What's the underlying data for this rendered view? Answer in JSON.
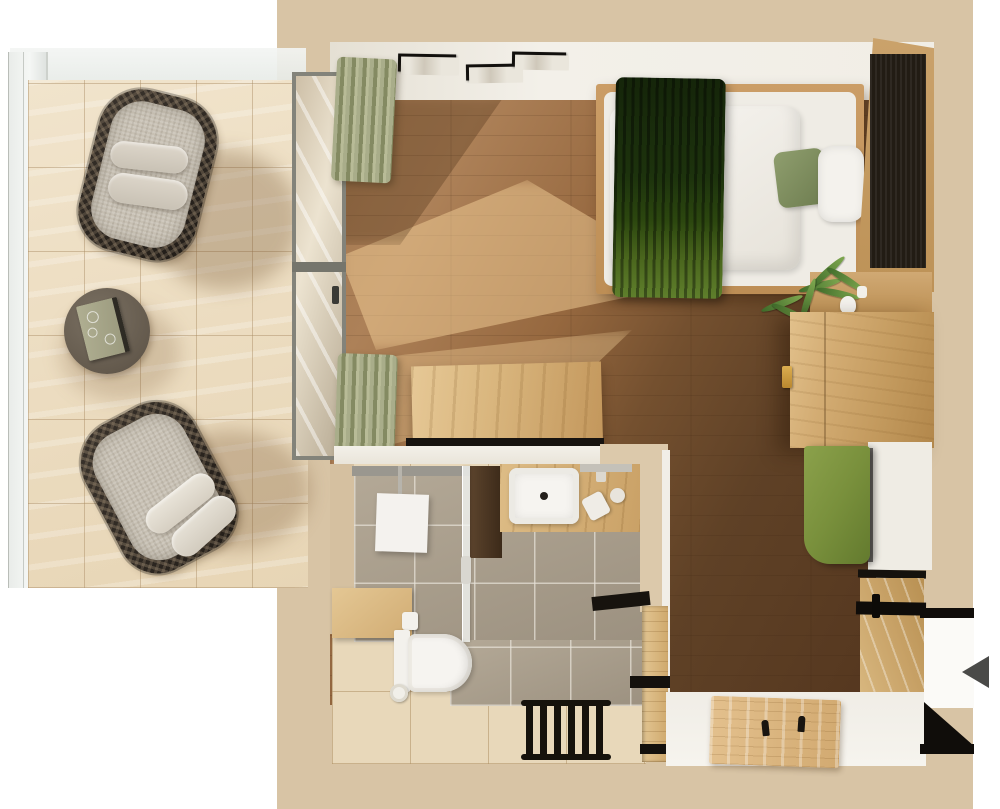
{
  "scene": {
    "title": "Studio apartment floor plan - top-down 3D render",
    "view": "top-down",
    "entrance_indicator": "left-pointing arrow at right wall opening"
  },
  "palette": {
    "page_background": "#ffffff",
    "wall_fill_beige": "#d8c4a5",
    "wall_top_white": "#f1eee7",
    "floor_wood_light": "#ad8158",
    "floor_wood_dark": "#55371f",
    "floor_sunlight": "#f3d098",
    "terrace_deck": "#ebdcc2",
    "glass_railing": "#eef1ef",
    "oak_furniture": "#cfa96f",
    "walnut_headboard": "#221c14",
    "bed_linen_white": "#efece5",
    "throw_green_dark": "#1d330d",
    "pillow_sage": "#8b9a6b",
    "bench_olive": "#79903c",
    "curtain_sage": "#9aa07c",
    "bathroom_tile_gray": "#aba08f",
    "bathroom_floor_tile": "#e8d8ba",
    "fixture_white": "#f6f4f0",
    "accent_black": "#14110d",
    "handle_gold": "#c89a3c",
    "arrow_gray": "#4a4a48"
  },
  "rooms": [
    {
      "id": "terrace",
      "name": "Terrace",
      "furniture": [
        "wood deck tiles",
        "glass railing",
        "lounge chair",
        "lounge chair",
        "round side table with book"
      ]
    },
    {
      "id": "living",
      "name": "Living / sleeping area",
      "furniture": [
        "double bed with green throw",
        "sage pillow",
        "white pillow",
        "walnut headboard panel",
        "three framed pictures",
        "sage curtains",
        "glass terrace door",
        "wall desk",
        "oak wardrobe",
        "olive upholstered bench",
        "shelf with plant and vases"
      ]
    },
    {
      "id": "bathroom",
      "name": "Bathroom",
      "furniture": [
        "walk-in shower",
        "rain shower head",
        "glass partition",
        "washbasin on oak counter",
        "wall-hung toilet",
        "toilet paper roll",
        "black towel radiator",
        "wood bench",
        "oak sliding door"
      ]
    },
    {
      "id": "entry",
      "name": "Entry",
      "furniture": [
        "oak coat board with hooks",
        "oak wall paneling",
        "entrance door opening"
      ]
    }
  ]
}
